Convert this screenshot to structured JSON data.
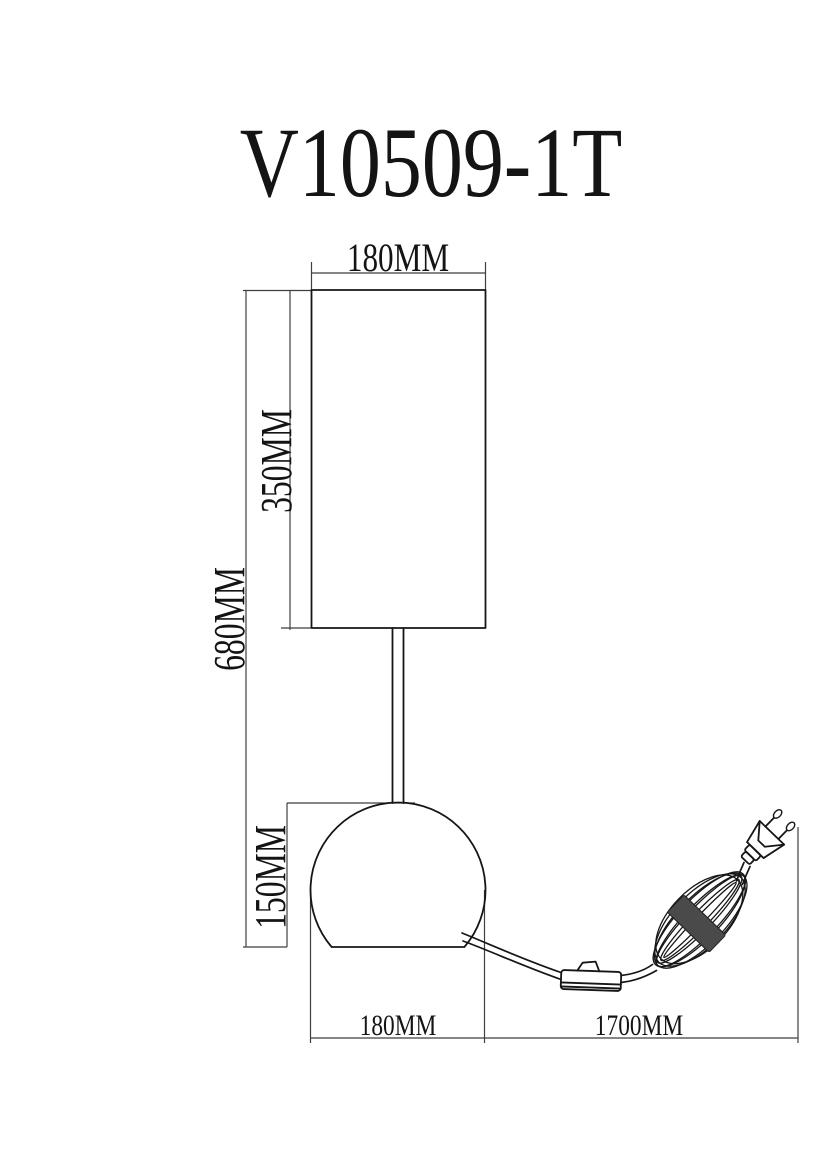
{
  "title": "V10509-1T",
  "dimensions": {
    "shade_width": "180MM",
    "shade_height": "350MM",
    "total_height": "680MM",
    "base_height": "150MM",
    "base_width": "180MM",
    "cord_length": "1700MM"
  },
  "drawing": {
    "parts": [
      "lamp-shade",
      "stem",
      "sphere-base",
      "power-cord",
      "inline-switch",
      "cord-coil",
      "eu-two-pin-plug"
    ],
    "colors": {
      "line": "#161616",
      "dimension_line": "#3f3f3f",
      "background": "#ffffff",
      "coil_band": "#4a4a4a"
    }
  }
}
